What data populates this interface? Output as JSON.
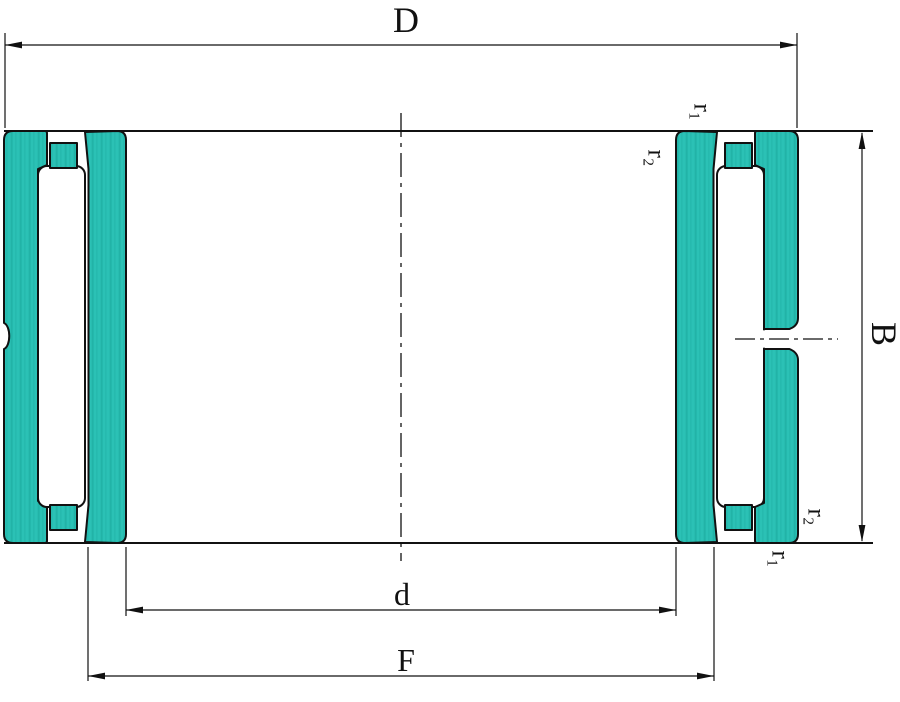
{
  "drawing": {
    "type": "bearing-cross-section",
    "description": "Technical dimension drawing of a needle roller bearing cross-section with inner ring, cage and lubrication hole",
    "labels": {
      "outer_diameter": "D",
      "width": "B",
      "bore": "d",
      "raceway_diameter": "F",
      "chamfer_r1": "r₁",
      "chamfer_r2": "r₂"
    },
    "colors": {
      "ring_fill": "#2bc1b5",
      "ring_streak": "#17a296",
      "line": "#111111",
      "background": "#ffffff"
    }
  }
}
